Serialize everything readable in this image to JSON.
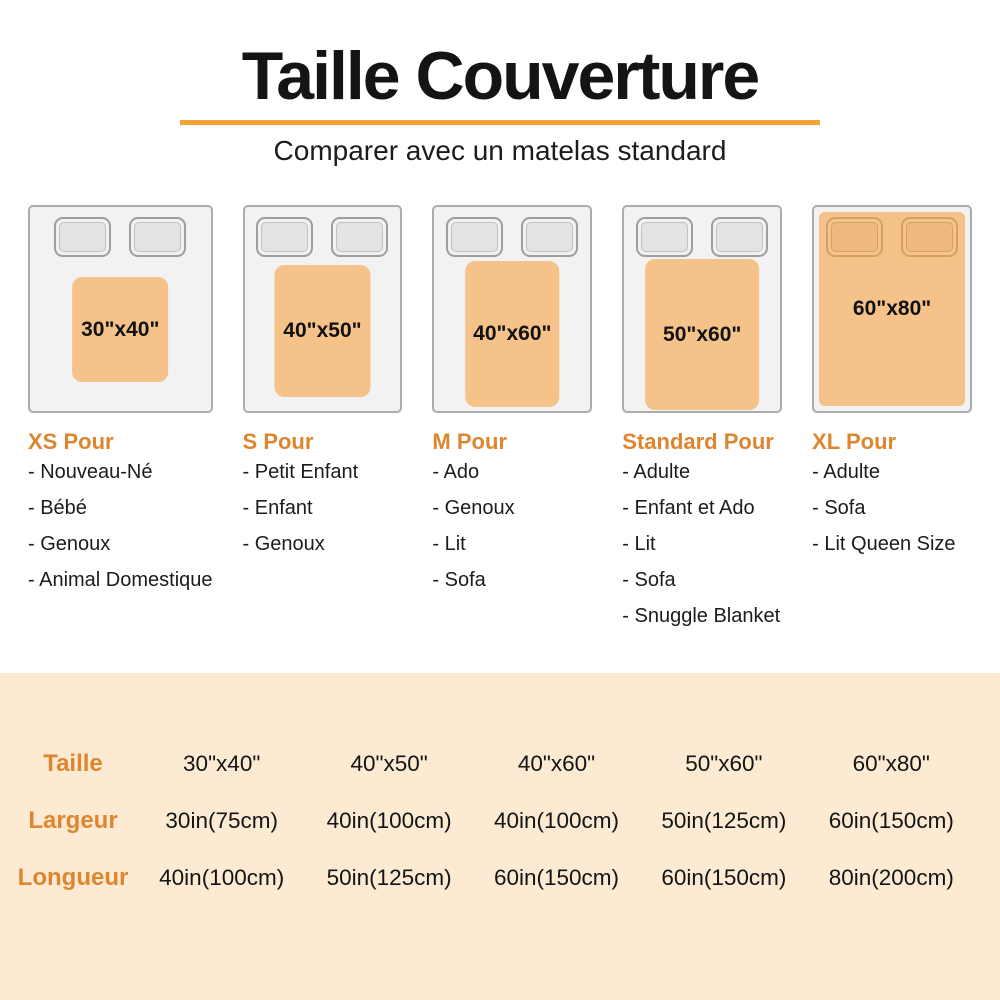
{
  "header": {
    "title": "Taille Couverture",
    "subtitle": "Comparer avec un matelas standard"
  },
  "list_bullet": "-",
  "columns": [
    {
      "size": "30\"x40\"",
      "category": "XS Pour",
      "blanket_covers_pillows": false,
      "uses": [
        "Nouveau-Né",
        "Bébé",
        "Genoux",
        "Animal Domestique"
      ]
    },
    {
      "size": "40\"x50\"",
      "category": "S Pour",
      "blanket_covers_pillows": false,
      "uses": [
        "Petit Enfant",
        "Enfant",
        "Genoux"
      ]
    },
    {
      "size": "40\"x60\"",
      "category": "M Pour",
      "blanket_covers_pillows": false,
      "uses": [
        "Ado",
        "Genoux",
        "Lit",
        "Sofa"
      ]
    },
    {
      "size": "50\"x60\"",
      "category": "Standard Pour",
      "blanket_covers_pillows": false,
      "uses": [
        "Adulte",
        "Enfant et Ado",
        "Lit",
        "Sofa",
        "Snuggle Blanket"
      ]
    },
    {
      "size": "60\"x80\"",
      "category": "XL Pour",
      "blanket_covers_pillows": true,
      "uses": [
        "Adulte",
        "Sofa",
        "Lit Queen Size"
      ]
    }
  ],
  "spec_table": {
    "rows": [
      {
        "label": "Taille",
        "values": [
          "30\"x40\"",
          "40\"x50\"",
          "40\"x60\"",
          "50\"x60\"",
          "60\"x80\""
        ]
      },
      {
        "label": "Largeur",
        "values": [
          "30in(75cm)",
          "40in(100cm)",
          "40in(100cm)",
          "50in(125cm)",
          "60in(150cm)"
        ]
      },
      {
        "label": "Longueur",
        "values": [
          "40in(100cm)",
          "50in(125cm)",
          "60in(150cm)",
          "60in(150cm)",
          "80in(200cm)"
        ]
      }
    ]
  },
  "colors": {
    "accent": "#DE862F",
    "underline": "#F4A435",
    "blanket": "#F5C28A",
    "table_bg": "#FCEAD3",
    "text": "#1D1D1F"
  }
}
